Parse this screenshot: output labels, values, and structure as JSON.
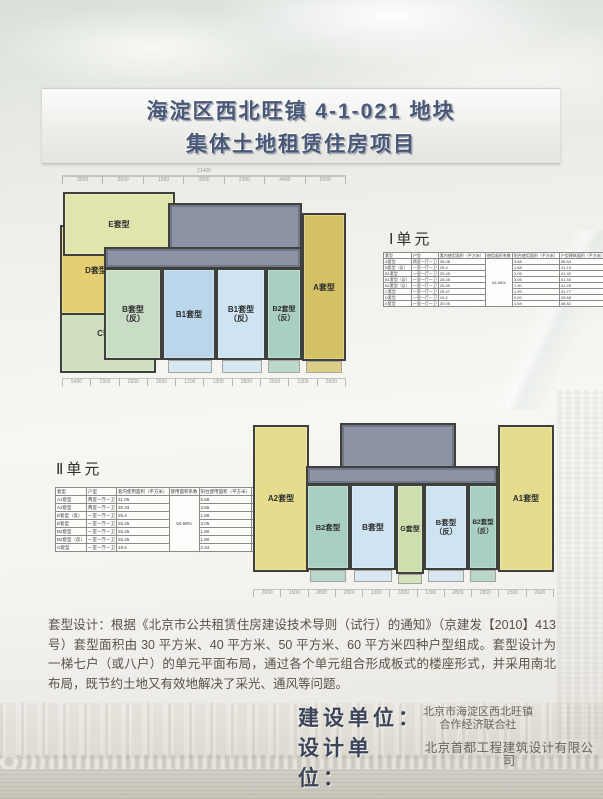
{
  "title": {
    "line1": "海淀区西北旺镇 4-1-021 地块",
    "line2": "集体土地租赁住房项目"
  },
  "plan1": {
    "section_label": "Ⅰ单元",
    "dims": {
      "total": "21400",
      "top": [
        "3500",
        "3600",
        "1500",
        "2800",
        "2300",
        "4400",
        "5000"
      ],
      "bottom": [
        "5400",
        "1300",
        "2600",
        "2600",
        "1300",
        "1300",
        "2600",
        "2600",
        "1300",
        "2600"
      ]
    },
    "units": {
      "E": {
        "label": "E套型"
      },
      "D": {
        "label": "D套型"
      },
      "C": {
        "label": "C套型"
      },
      "B_rev": {
        "label": "B套型",
        "sub": "（反）"
      },
      "B1": {
        "label": "B1套型"
      },
      "B1_rev": {
        "label": "B1套型",
        "sub": "（反）"
      },
      "B2_rev": {
        "label": "B2套型",
        "sub": "（反）"
      },
      "A": {
        "label": "A套型"
      }
    },
    "table": {
      "headers": [
        "套型",
        "户型",
        "套内使用面积（平方米）",
        "使用面积系数",
        "阳台使用面积（平方米）",
        "户型建筑面积（平方米）"
      ],
      "coeff": "64.68%",
      "rows": [
        [
          "A套型",
          "两室一厅一卫",
          "35.08",
          "3.68",
          "58.54"
        ],
        [
          "B套型（反）",
          "一室一厅一卫",
          "25.4",
          "1.88",
          "41.15"
        ],
        [
          "B1套型",
          "一室一厅一卫",
          "25.45",
          "3.05",
          "41.40"
        ],
        [
          "B1套型（反）",
          "一室一厅一卫",
          "25.45",
          "3.05",
          "41.40"
        ],
        [
          "B2套型（反）",
          "一室一厅一卫",
          "25.45",
          "1.90",
          "41.25"
        ],
        [
          "C套型",
          "一室一厅一卫",
          "25.47",
          "1.99",
          "41.77"
        ],
        [
          "D套型",
          "一室一厅一卫",
          "19.2",
          "0.00",
          "29.68"
        ],
        [
          "E套型",
          "一室一厅一卫",
          "30.05",
          "3.58",
          "48.82"
        ]
      ]
    }
  },
  "plan2": {
    "section_label": "Ⅱ单元",
    "dims": {
      "bottom": [
        "2600",
        "1500",
        "2800",
        "2800",
        "1300",
        "3300",
        "1300",
        "2800",
        "2800",
        "1500",
        "2600"
      ]
    },
    "units": {
      "A2": {
        "label": "A2套型"
      },
      "B2": {
        "label": "B2套型"
      },
      "B": {
        "label": "B套型"
      },
      "G": {
        "label": "G套型"
      },
      "B_rev": {
        "label": "B套型",
        "sub": "（反）"
      },
      "B2_rev": {
        "label": "B2套型",
        "sub": "（反）"
      },
      "A1": {
        "label": "A1套型"
      }
    },
    "table": {
      "headers": [
        "套型",
        "户型",
        "套内使用面积（平方米）",
        "使用面积系数",
        "阳台使用面积（平方米）",
        "户型建筑面积（平方米）"
      ],
      "coeff": "64.68%",
      "rows": [
        [
          "A1套型",
          "两室一厅一卫",
          "31.05",
          "5.58",
          "51.57"
        ],
        [
          "A2套型",
          "两室一厅一卫",
          "35.33",
          "3.65",
          "58.26"
        ],
        [
          "B套型（反）",
          "一室一厅一卫",
          "25.4",
          "1.88",
          "41.15"
        ],
        [
          "B套型",
          "一室一厅一卫",
          "25.45",
          "3.05",
          "41.40"
        ],
        [
          "B2套型",
          "一室一厅一卫",
          "25.45",
          "1.90",
          "41.25"
        ],
        [
          "B2套型（反）",
          "一室一厅一卫",
          "25.45",
          "1.90",
          "41.25"
        ],
        [
          "G套型",
          "一室一厅一卫",
          "18.5",
          "2.34",
          "33.11"
        ]
      ]
    }
  },
  "paragraph": "套型设计：根据《北京市公共租赁住房建设技术导则（试行）的通知》（京建发【2010】413 号）套型面积由 30 平方米、40 平方米、50 平方米、60 平方米四种户型组成。套型设计为一梯七户（或八户）的单元平面布局，通过各个单元组合形成板式的楼座形式，并采用南北布局，既节约土地又有效地解决了采光、通风等问题。",
  "credits": {
    "builder_label": "建设单位：",
    "builder_line1": "北京市海淀区西北旺镇",
    "builder_line2": "合作经济联合社",
    "designer_label": "设计单位：",
    "designer_value": "北京首都工程建筑设计有限公司"
  },
  "colors": {
    "title_text": "#4a5877",
    "core_gray": "#8b93a4",
    "unit_gold": "#d4c165",
    "unit_dark_yellow": "#e5cf72",
    "unit_pale_yellow": "#e6dc8e",
    "unit_lime": "#dfe5ad",
    "unit_green": "#cfdfc0",
    "unit_teal_green": "#c9dcc6",
    "unit_blue": "#b9d6ea",
    "unit_light_blue": "#cfe4f2",
    "unit_teal": "#a8cfc2",
    "unit_g_lime": "#ccdfad"
  }
}
